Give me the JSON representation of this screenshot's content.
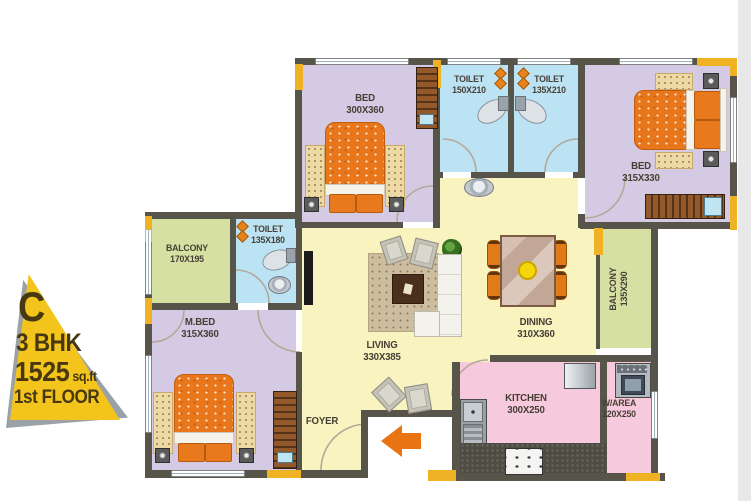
{
  "plan": {
    "badge": {
      "unit_letter": "C",
      "type": "3 BHK",
      "area_value": "1525",
      "area_unit": "sq.ft",
      "floor": "1st FLOOR"
    },
    "rooms": {
      "bed1": {
        "name": "BED",
        "dims": "300X360"
      },
      "toilet1": {
        "name": "TOILET",
        "dims": "150X210"
      },
      "toilet2": {
        "name": "TOILET",
        "dims": "135X210"
      },
      "bed2": {
        "name": "BED",
        "dims": "315X330"
      },
      "balcony1": {
        "name": "BALCONY",
        "dims": "170X195"
      },
      "toilet3": {
        "name": "TOILET",
        "dims": "135X180"
      },
      "mbed": {
        "name": "M.BED",
        "dims": "315X360"
      },
      "living": {
        "name": "LIVING",
        "dims": "330X385"
      },
      "dining": {
        "name": "DINING",
        "dims": "310X360"
      },
      "balcony2": {
        "name": "BALCONY",
        "dims": "135X290"
      },
      "kitchen": {
        "name": "KITCHEN",
        "dims": "300X250"
      },
      "warea": {
        "name": "W/AREA",
        "dims": "120X250"
      },
      "foyer": {
        "name": "FOYER",
        "dims": ""
      }
    },
    "colors": {
      "wall": "#57544a",
      "column_yellow": "#f0b225",
      "bedroom_floor": "#d5cae4",
      "toilet_floor": "#bce3f4",
      "living_floor": "#f9f3c0",
      "balcony_floor": "#d5e0a2",
      "kitchen_floor": "#f7c9dc",
      "furniture_orange": "#e8761b",
      "badge_yellow": "#f2c41c",
      "entry_arrow": "#e87413"
    }
  }
}
